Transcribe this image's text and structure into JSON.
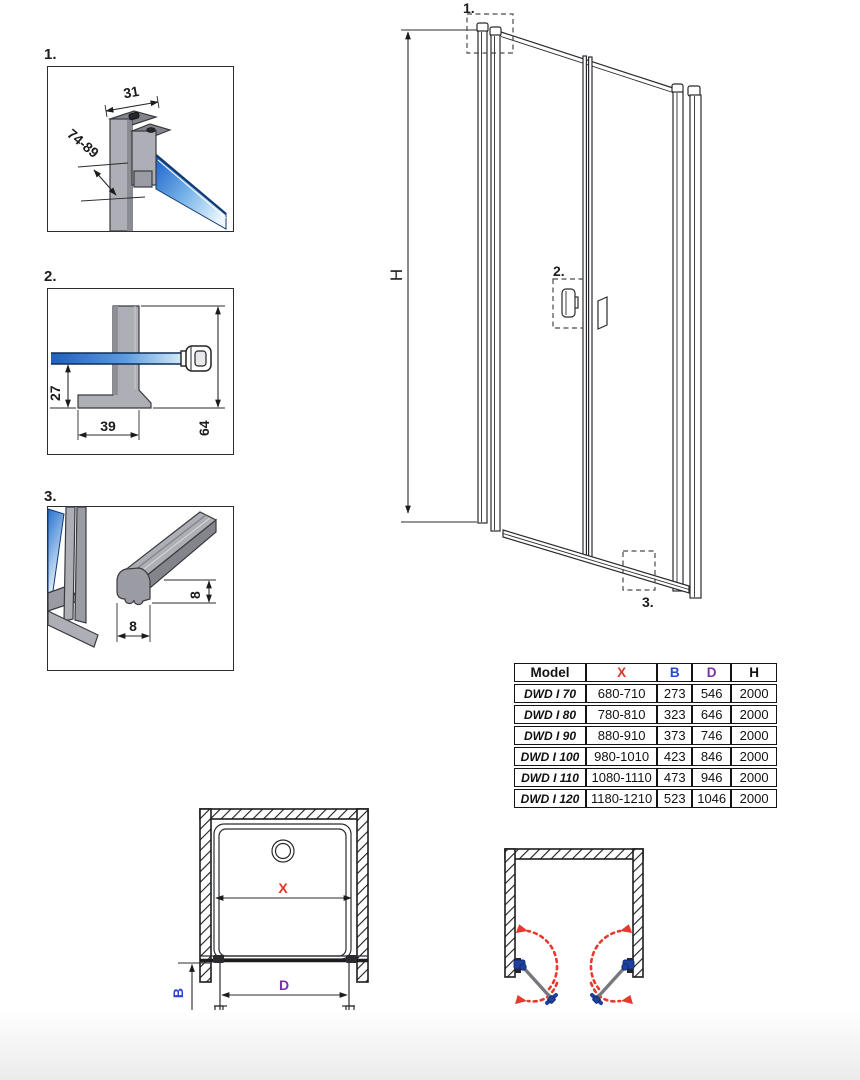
{
  "colors": {
    "line": "#2a2b2e",
    "accent_red": "#e33128",
    "accent_blue": "#2a46cf",
    "accent_purple": "#7b2fa8",
    "arc_red": "#e8392f",
    "hinge_blue": "#1e409f",
    "glass_blue": "#2470cd",
    "profile_gray": "#aeafb6"
  },
  "detail1": {
    "label": "1.",
    "dim_width": "31",
    "dim_adjust": "74-89"
  },
  "detail2": {
    "label": "2.",
    "dim_offset": "27",
    "dim_foot": "39",
    "dim_height": "64"
  },
  "detail3": {
    "label": "3.",
    "dim_w": "8",
    "dim_h": "8"
  },
  "elevation": {
    "h_label": "H",
    "callout_1": "1.",
    "callout_2": "2.",
    "callout_3": "3."
  },
  "plan": {
    "x_label": "X",
    "b_label": "B",
    "d_label": "D"
  },
  "table": {
    "headers": {
      "model": "Model",
      "x": "X",
      "b": "B",
      "d": "D",
      "h": "H"
    },
    "rows": [
      {
        "model": "DWD I 70",
        "x": "680-710",
        "b": "273",
        "d": "546",
        "h": "2000"
      },
      {
        "model": "DWD I 80",
        "x": "780-810",
        "b": "323",
        "d": "646",
        "h": "2000"
      },
      {
        "model": "DWD I 90",
        "x": "880-910",
        "b": "373",
        "d": "746",
        "h": "2000"
      },
      {
        "model": "DWD I 100",
        "x": "980-1010",
        "b": "423",
        "d": "846",
        "h": "2000"
      },
      {
        "model": "DWD I 110",
        "x": "1080-1110",
        "b": "473",
        "d": "946",
        "h": "2000"
      },
      {
        "model": "DWD I 120",
        "x": "1180-1210",
        "b": "523",
        "d": "1046",
        "h": "2000"
      }
    ]
  }
}
